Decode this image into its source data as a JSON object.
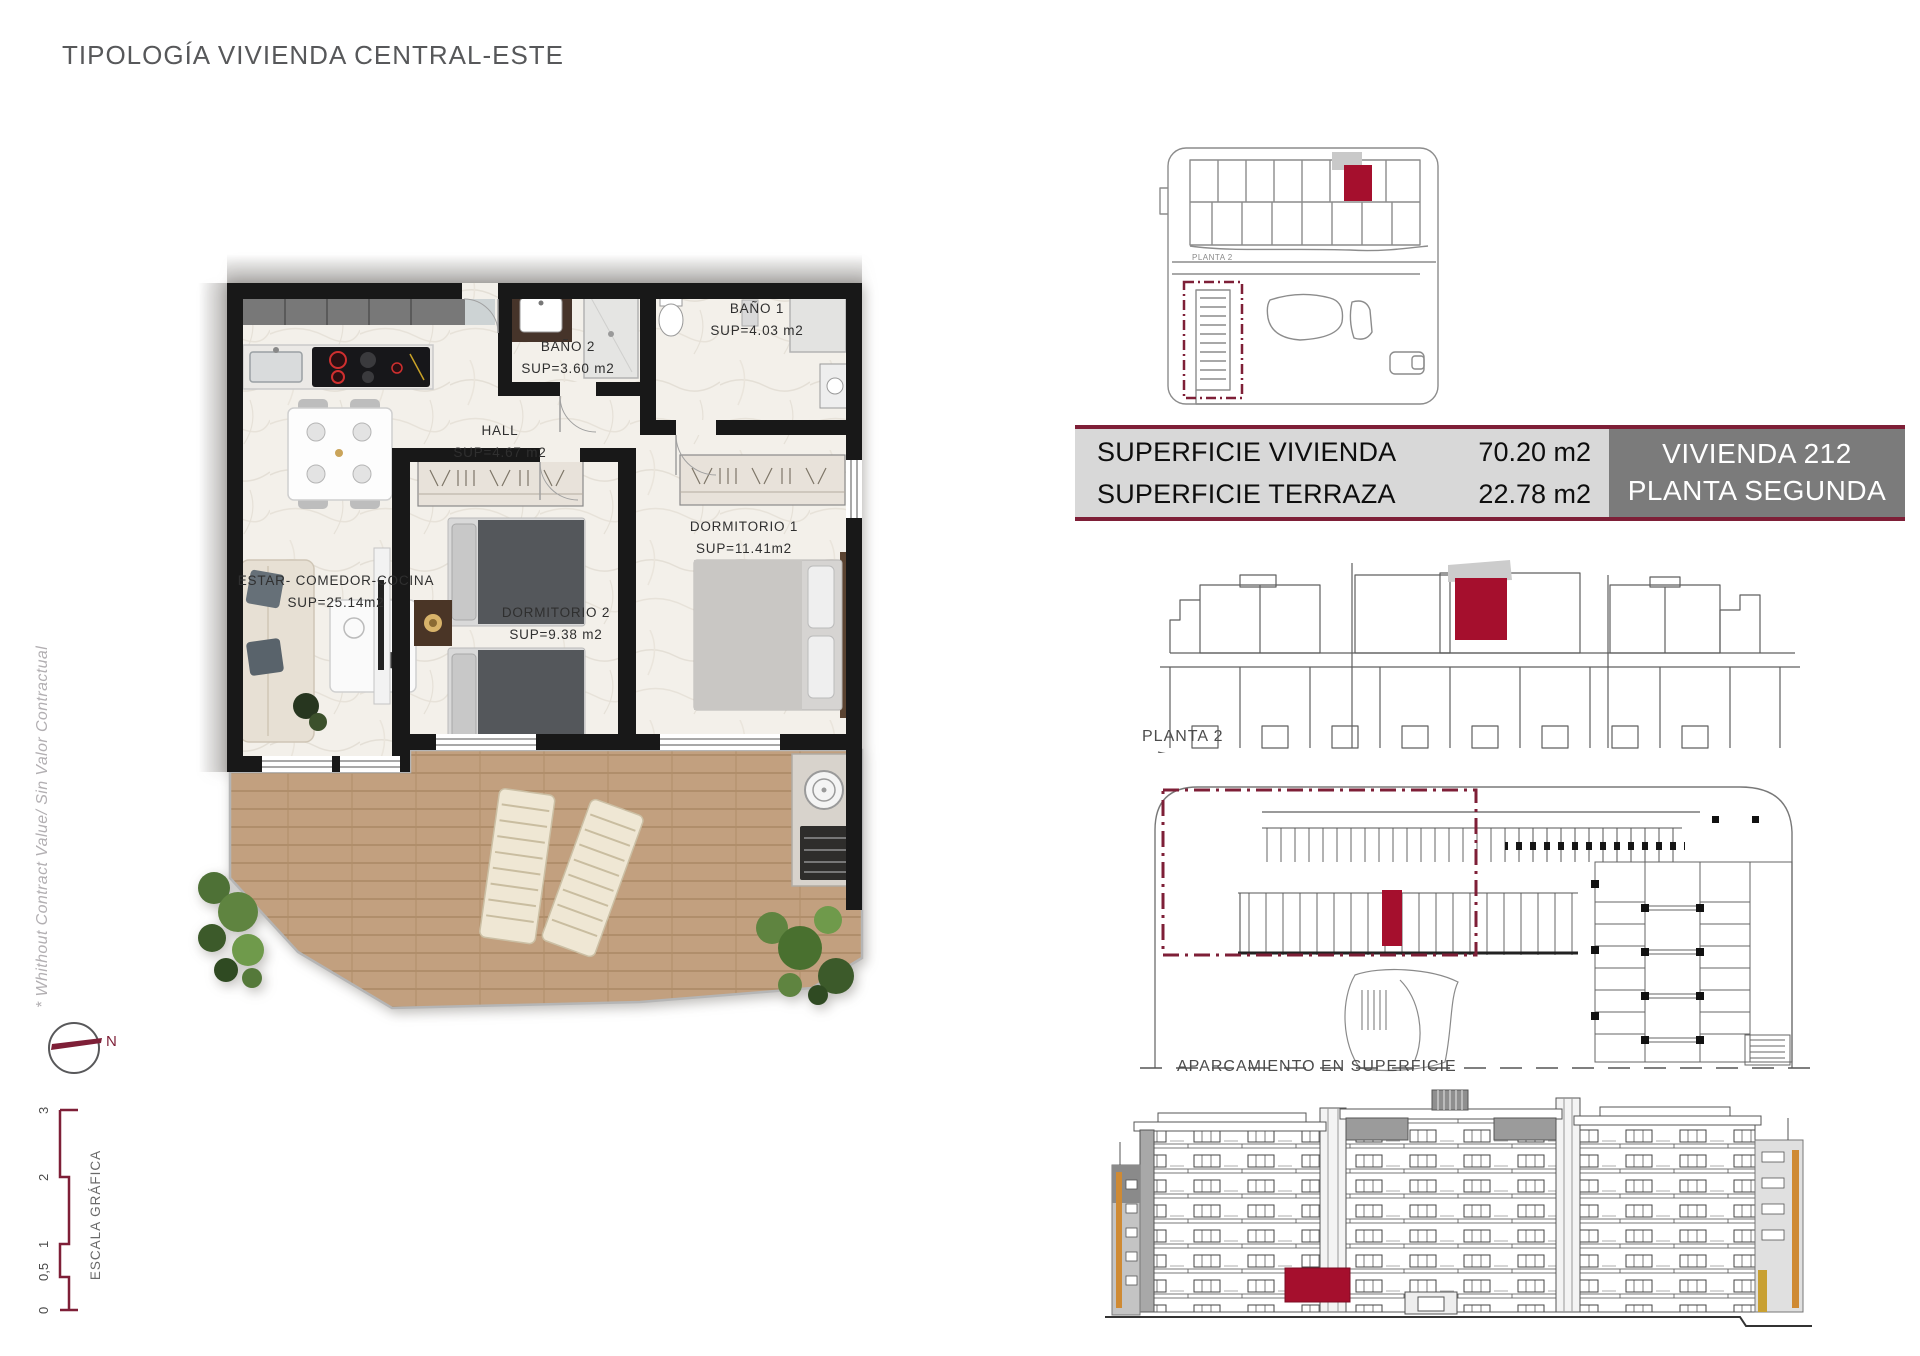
{
  "title": "TIPOLOGÍA VIVIENDA CENTRAL-ESTE",
  "disclaimer": "* Whithout Contract Value/ Sin Valor Contractual",
  "colors": {
    "maroon": "#7e1f37",
    "unit_red": "#a50f2d",
    "panel_light_bg": "#d8d8d8",
    "panel_dark_bg": "#7b7b7b",
    "title_gray": "#57585a"
  },
  "summary": {
    "rows": [
      {
        "label": "SUPERFICIE VIVIENDA",
        "value": "70.20 m2"
      },
      {
        "label": "SUPERFICIE TERRAZA",
        "value": "22.78 m2"
      }
    ],
    "unit_name": "VIVIENDA 212",
    "unit_floor": "PLANTA SEGUNDA"
  },
  "floorplan": {
    "rooms": [
      {
        "name": "BAÑO 1",
        "area": "SUP=4.03 m2"
      },
      {
        "name": "BAÑO 2",
        "area": "SUP=3.60 m2"
      },
      {
        "name": "HALL",
        "area": "SUP=4.67 m2"
      },
      {
        "name": "DORMITORIO 1",
        "area": "SUP=11.41m2"
      },
      {
        "name": "DORMITORIO 2",
        "area": "SUP=9.38 m2"
      },
      {
        "name": "ESTAR- COMEDOR-COCINA",
        "area": "SUP=25.14m2"
      }
    ]
  },
  "keyplan": {
    "floor_label": "PLANTA 2"
  },
  "elevation": {
    "label": "PLANTA 2"
  },
  "parking": {
    "label": "APARCAMIENTO EN SUPERFICIE"
  },
  "compass": {
    "north": "N"
  },
  "scalebar": {
    "title": "ESCALA GRÁFICA",
    "ticks": [
      "3",
      "2",
      "1",
      "0,5",
      "0"
    ]
  }
}
